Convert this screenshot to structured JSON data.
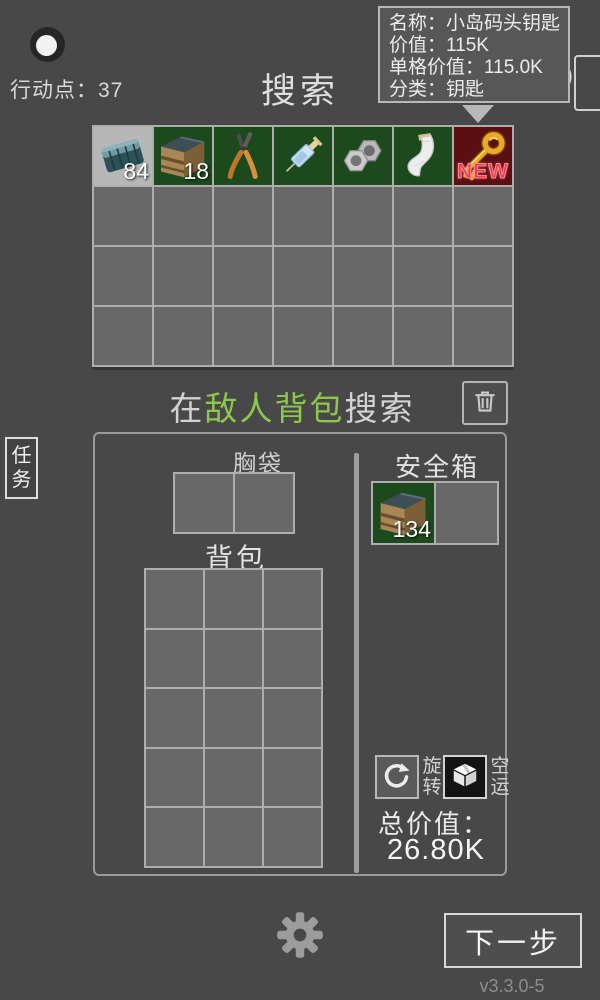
{
  "window": {
    "action_points_label": "行动点：",
    "action_points_value": "37",
    "title": "搜索",
    "version": "v3.3.0-5"
  },
  "tooltip": {
    "lines": [
      {
        "label": "名称：",
        "value": "小岛码头钥匙"
      },
      {
        "label": "价值：",
        "value": "115K"
      },
      {
        "label": "单格价值：",
        "value": "115.0K"
      },
      {
        "label": "分类：",
        "value": "钥匙"
      }
    ]
  },
  "search_grid": {
    "rows": 4,
    "cols": 7,
    "items": [
      {
        "row": 0,
        "col": 0,
        "icon": "ammo-box-icon",
        "count": "84",
        "slot_bg": "#b7b7b7"
      },
      {
        "row": 0,
        "col": 1,
        "icon": "crate-icon",
        "count": "18",
        "slot_bg": "#1d4a1d"
      },
      {
        "row": 0,
        "col": 2,
        "icon": "pliers-icon",
        "slot_bg": "#1d4a1d"
      },
      {
        "row": 0,
        "col": 3,
        "icon": "syringe-icon",
        "slot_bg": "#1d4a1d"
      },
      {
        "row": 0,
        "col": 4,
        "icon": "nuts-icon",
        "slot_bg": "#1d4a1d"
      },
      {
        "row": 0,
        "col": 5,
        "icon": "bandage-icon",
        "slot_bg": "#1d4a1d"
      },
      {
        "row": 0,
        "col": 6,
        "icon": "key-icon",
        "badge": "NEW",
        "slot_bg": "#5c0f13"
      }
    ]
  },
  "search_location": {
    "prefix": "在",
    "target": "敌人背包",
    "suffix": "搜索"
  },
  "tasks_button": {
    "label": "任务"
  },
  "panel": {
    "chest_pocket": {
      "label": "胸袋",
      "rows": 1,
      "cols": 2,
      "items": []
    },
    "backpack": {
      "label": "背包",
      "rows": 5,
      "cols": 3,
      "items": []
    },
    "safe": {
      "label": "安全箱",
      "rows": 1,
      "cols": 2,
      "items": [
        {
          "row": 0,
          "col": 0,
          "icon": "crate-icon",
          "count": "134",
          "slot_bg": "#1d4a1d"
        }
      ]
    },
    "rotate_label": "旋转",
    "airlift_label": "空运",
    "total_label": "总价值：",
    "total_value": "26.80K"
  },
  "footer": {
    "next_label": "下一步"
  },
  "colors": {
    "highlight_green": "#8cc84b",
    "slot_green": "#1d4a1d",
    "slot_red": "#5c0f13",
    "slot_gray": "#b7b7b7",
    "new_badge_red": "#f5394a"
  }
}
